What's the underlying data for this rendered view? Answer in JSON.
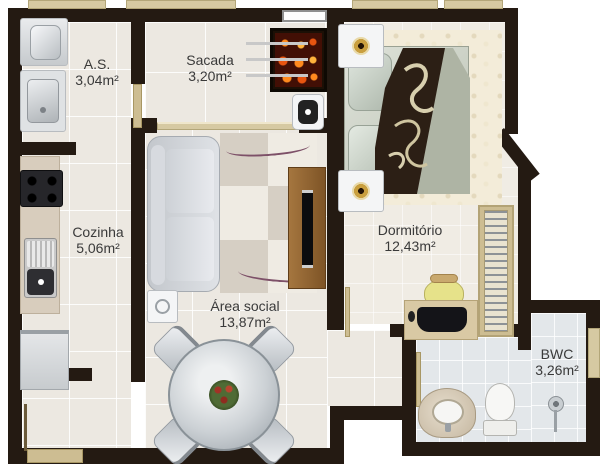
{
  "plan": {
    "title": "Apartment floor plan",
    "rooms": [
      {
        "name": "A.S.",
        "area": "3,04m²"
      },
      {
        "name": "Sacada",
        "area": "3,20m²"
      },
      {
        "name": "Cozinha",
        "area": "5,06m²"
      },
      {
        "name": "Área social",
        "area": "13,87m²"
      },
      {
        "name": "Dormitório",
        "area": "12,43m²"
      },
      {
        "name": "BWC",
        "area": "3,26m²"
      }
    ],
    "colors": {
      "wall": "#241a12",
      "floor": "#ece8e1",
      "bathroom_floor": "#e3e7ea",
      "window_sill": "#d6c9a2",
      "tv_panel_wood": "#9c6b35",
      "grill_coals": "#d23b10",
      "label_text": "#3a3a3a"
    }
  }
}
